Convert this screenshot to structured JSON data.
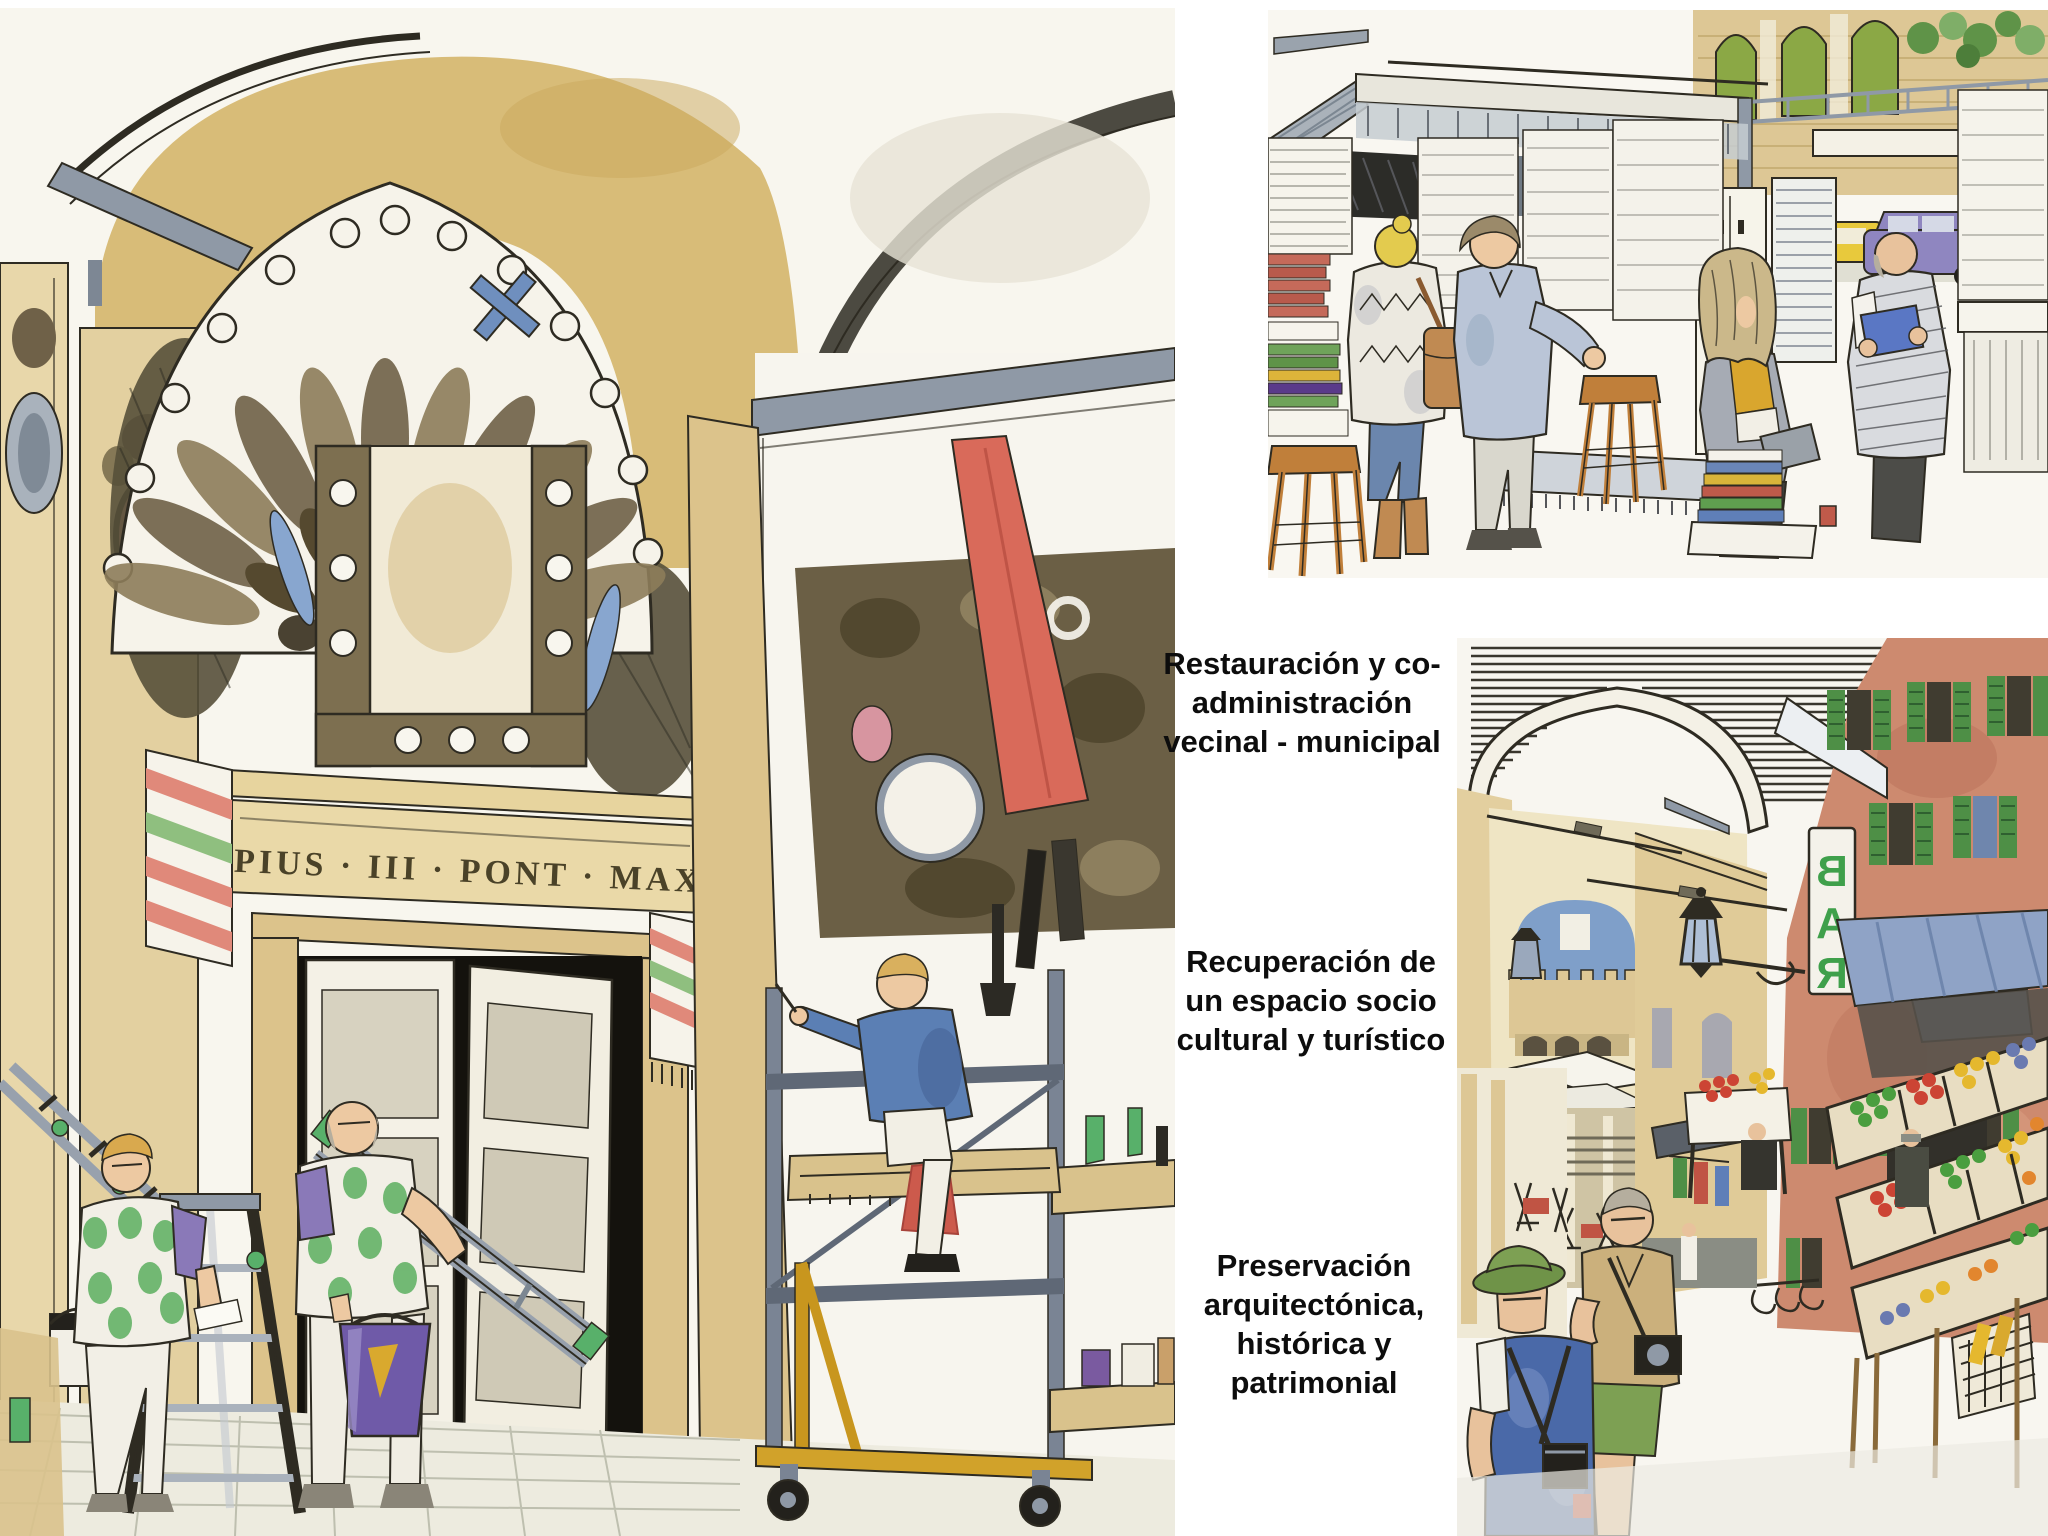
{
  "page": {
    "width": 2048,
    "height": 1536,
    "background": "#ffffff"
  },
  "captions": {
    "restoration": {
      "lines": [
        "Restauración y co-",
        "administración",
        "vecinal - municipal"
      ]
    },
    "recovery": {
      "lines": [
        "Recuperación de",
        "un espacio socio",
        "cultural y turístico"
      ]
    },
    "preservation": {
      "lines": [
        "Preservación",
        "arquitectónica,",
        "histórica y",
        "patrimonial"
      ]
    }
  },
  "illustrations": {
    "portal_restoration": {
      "inscription": "PIUS · III · PONT · MAX"
    },
    "street_market": {
      "bar_sign_letters": [
        "B",
        "A",
        "R"
      ]
    }
  },
  "palette": {
    "paper": "#f8f6ee",
    "ochre_wash": "#d5b66e",
    "tan_stone": "#dcc38b",
    "sepia_ornament": "#6f6148",
    "ink_sepia": "#4a4228",
    "steel_grey": "#8f99a6",
    "vest_green": "#5caf5f",
    "sleeve_purple": "#8a79b8",
    "shirt_blue": "#5b7fb4",
    "banner_red": "#d96a5a",
    "sky_blue": "#7f9fc9",
    "shutter_green": "#4e8f46",
    "terracotta": "#cd8a6f",
    "bar_sign_green": "#3fa04b",
    "produce_red": "#cc4434",
    "produce_green": "#4a9e3f",
    "produce_yellow": "#e5b82e",
    "awning_blue": "#8fa3c6",
    "wood_stool": "#c07f3a",
    "denim_blue": "#4a69a8"
  }
}
